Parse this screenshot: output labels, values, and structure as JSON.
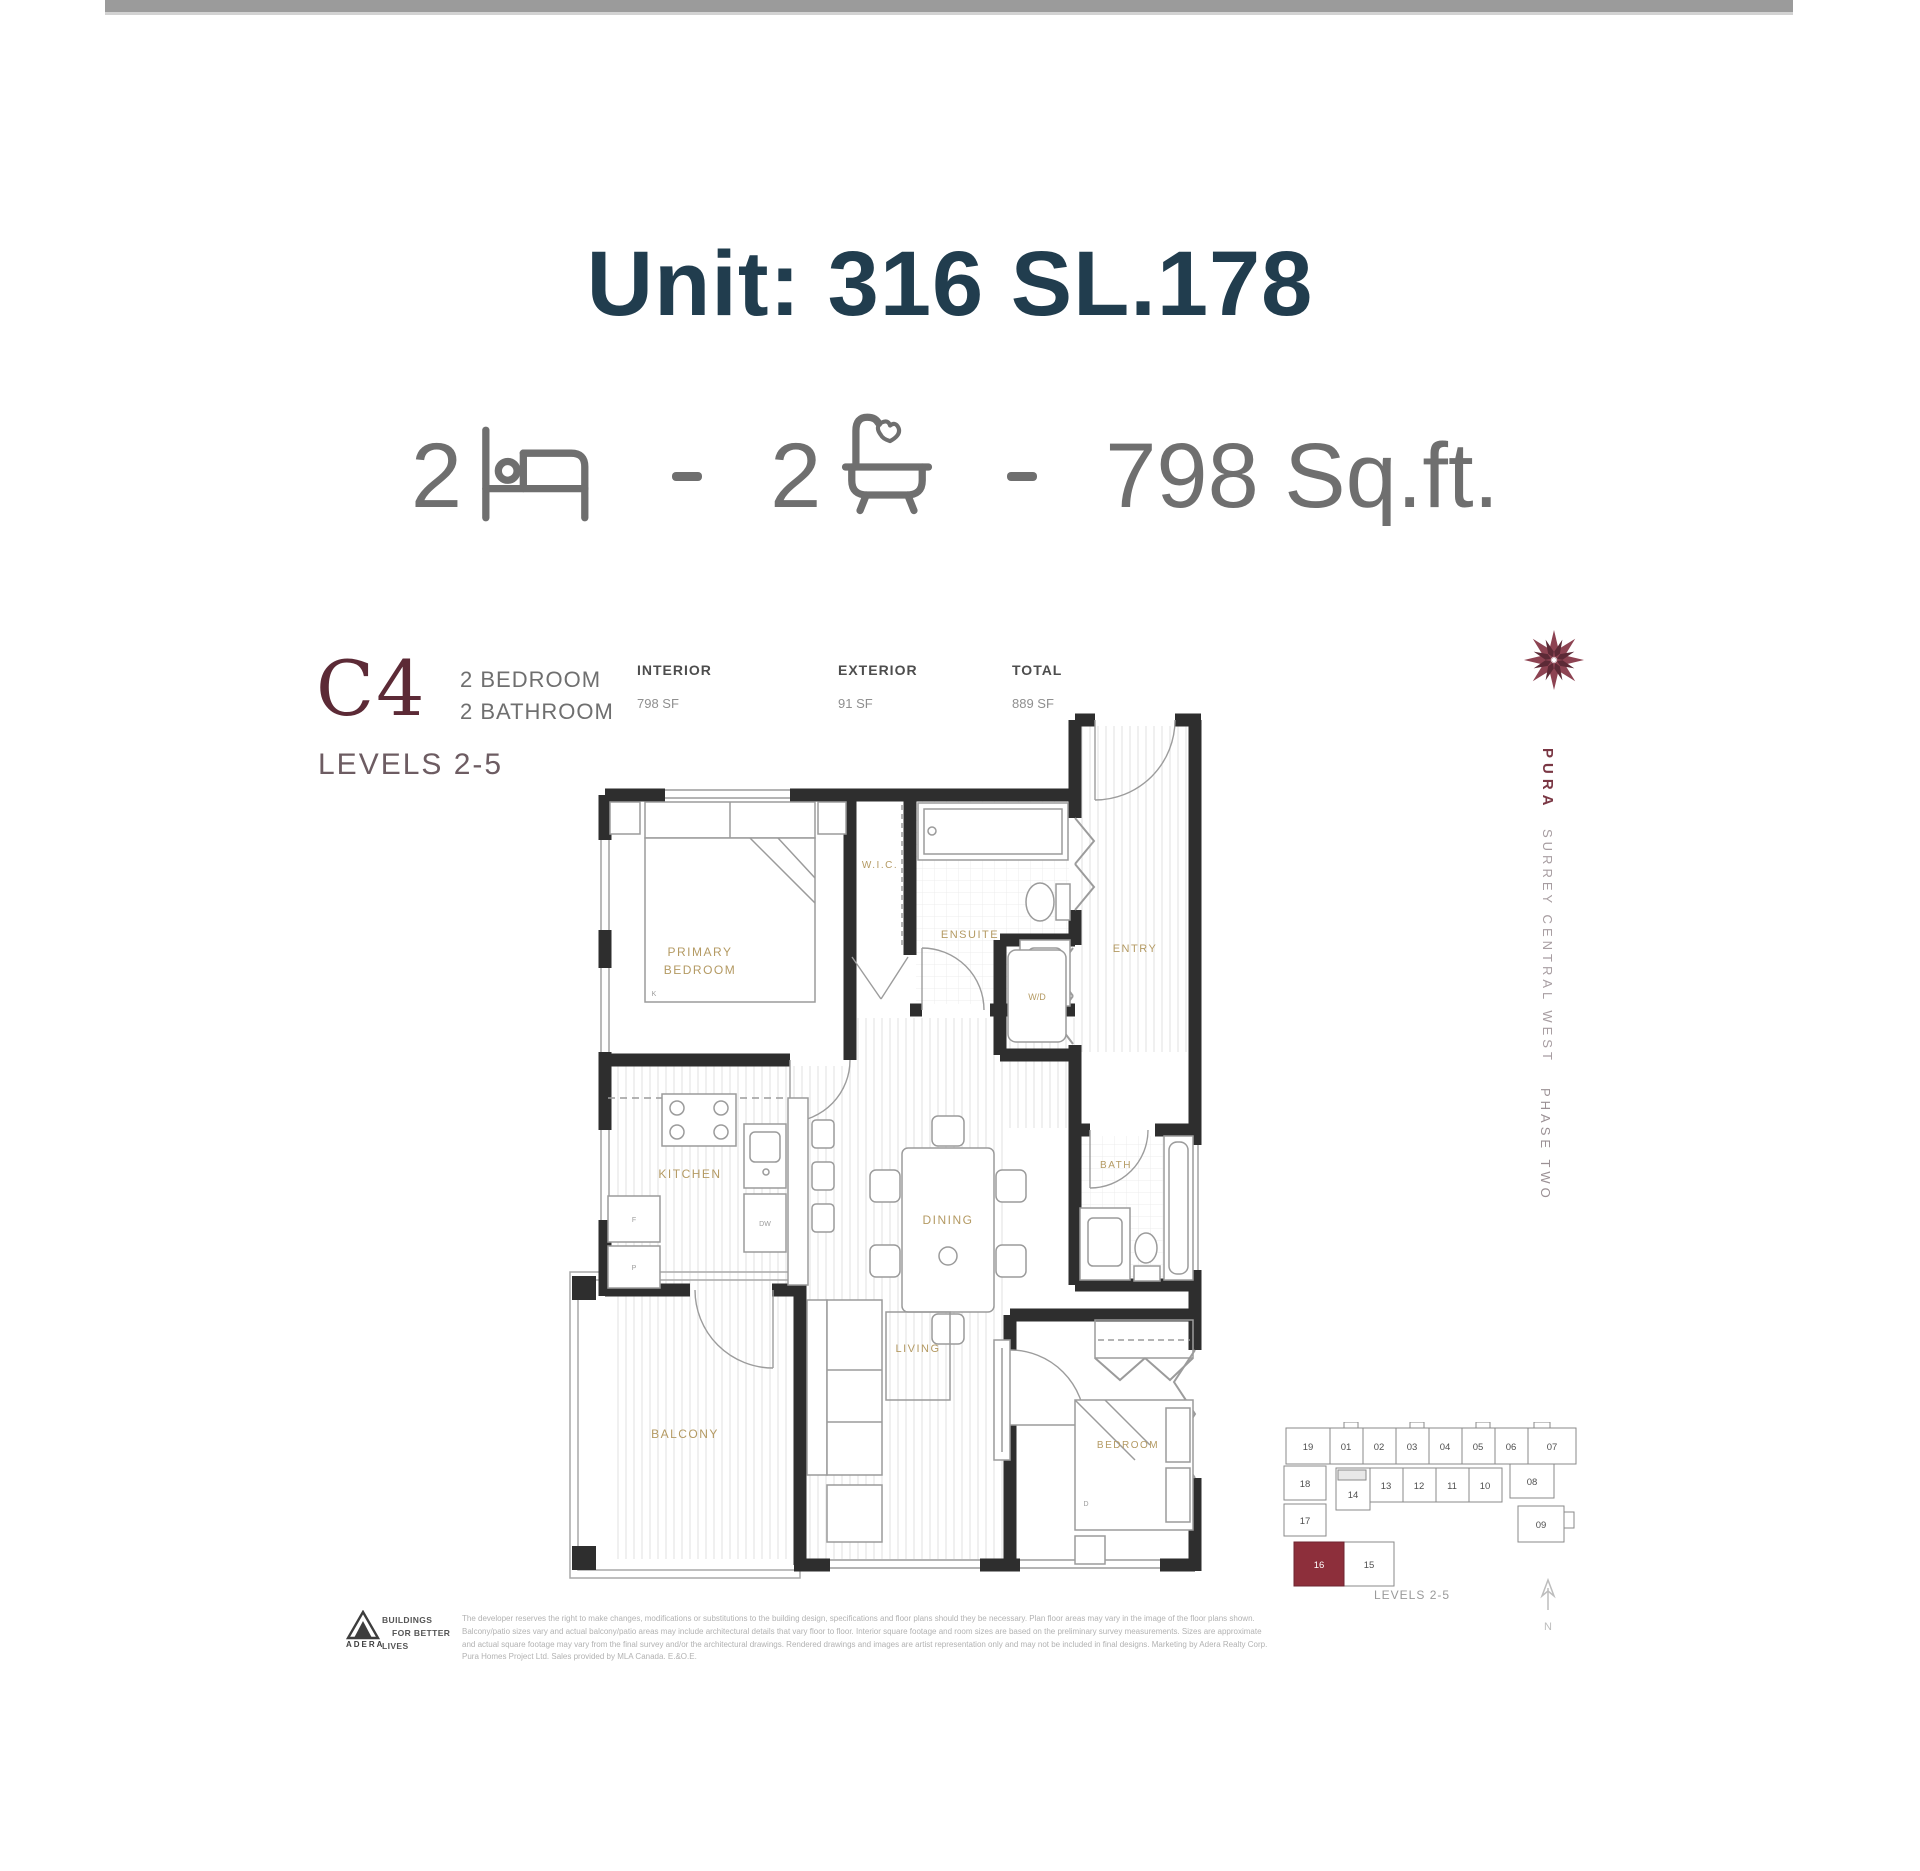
{
  "header": {
    "title": "Unit: 316 SL.178"
  },
  "summary": {
    "bed_count": "2",
    "bath_count": "2",
    "area": "798 Sq.ft."
  },
  "plan_header": {
    "code": "C4",
    "type_line1": "2 BEDROOM",
    "type_line2": "2 BATHROOM",
    "levels": "LEVELS 2-5",
    "stats": [
      {
        "label": "INTERIOR",
        "value": "798 SF"
      },
      {
        "label": "EXTERIOR",
        "value": "91 SF"
      },
      {
        "label": "TOTAL",
        "value": "889 SF"
      }
    ]
  },
  "floorplan": {
    "labels": {
      "primary1": "PRIMARY",
      "primary2": "BEDROOM",
      "k": "K",
      "wic": "W.I.C.",
      "ensuite": "ENSUITE",
      "entry": "ENTRY",
      "wd": "W/D",
      "kitchen": "KITCHEN",
      "dw": "DW",
      "f": "F",
      "p": "P",
      "dining": "DINING",
      "bath": "BATH",
      "balcony": "BALCONY",
      "living": "LIVING",
      "bedroom": "BEDROOM",
      "d": "D"
    }
  },
  "sidebar": {
    "brand": "PURA",
    "project": "SURREY CENTRAL WEST",
    "phase": "PHASE TWO"
  },
  "keyplan": {
    "units": [
      "19",
      "01",
      "02",
      "03",
      "04",
      "05",
      "06",
      "07",
      "18",
      "14",
      "13",
      "12",
      "11",
      "10",
      "08",
      "17",
      "09",
      "16",
      "15"
    ],
    "highlighted_unit": "16",
    "caption": "LEVELS 2-5",
    "north": "N"
  },
  "footer": {
    "brand": "ADERA",
    "tagline1": "BUILDINGS",
    "tagline2": "FOR BETTER",
    "tagline3": "LIVES",
    "disclaimer": "The developer reserves the right to make changes, modifications or substitutions to the building design, specifications and floor plans should they be necessary. Plan floor areas may vary in the image of the floor plans shown. Balcony/patio sizes vary and actual balcony/patio areas may include architectural details that vary floor to floor. Interior square footage and room sizes are based on the preliminary survey measurements. Sizes are approximate and actual square footage may vary from the final survey and/or the architectural drawings. Rendered drawings and images are artist representation only and may not be included in final designs. Marketing by Adera Realty Corp. Pura Homes Project Ltd. Sales provided by MLA Canada. E.&O.E."
  }
}
